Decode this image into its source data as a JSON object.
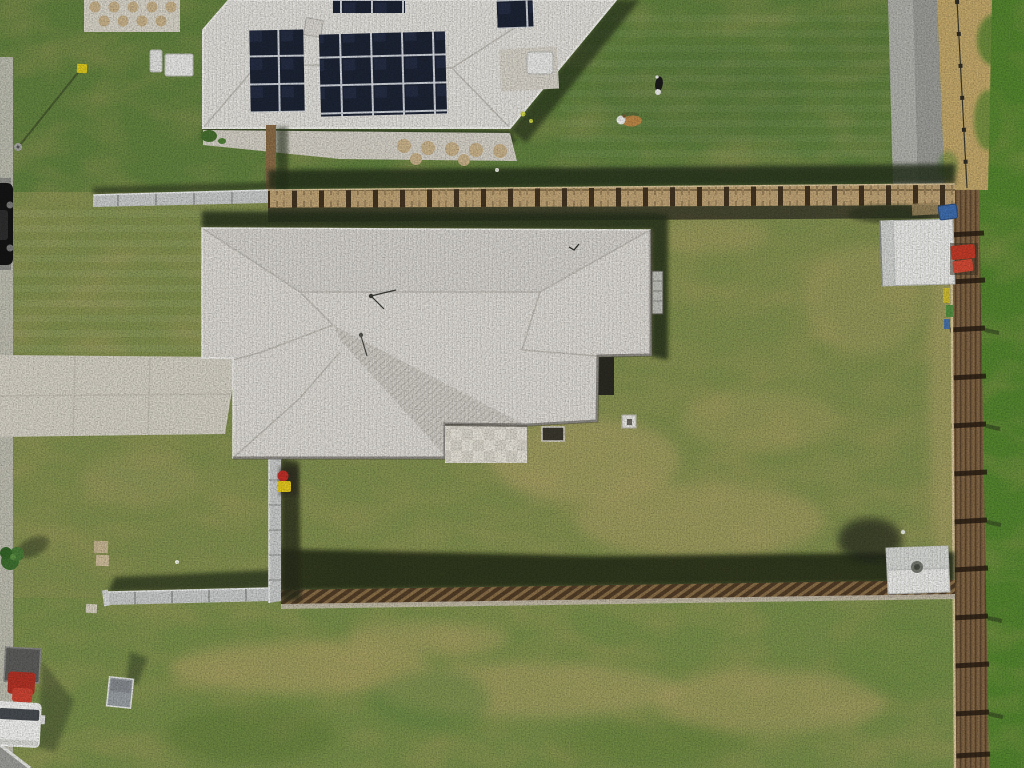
{
  "scene": {
    "type": "aerial-drone-photograph",
    "description": "Top-down drone photo of a suburban property: house with light grey hip roof, large olive-green yard, timber boundary fences, neighbouring house with rooftop solar panels, two dogs on neighbour lawn, white shed, driveway, street with parked vehicles",
    "objects": [
      {
        "name": "main-house-roof",
        "desc": "light grey corrugated hip roof",
        "box": [
          202,
          228,
          449,
          230
        ]
      },
      {
        "name": "neighbor-house-roof",
        "desc": "white corrugated roof with solar arrays",
        "box": [
          203,
          0,
          413,
          128
        ]
      },
      {
        "name": "solar-panels",
        "desc": "dark navy photovoltaic arrays",
        "box": [
          250,
          0,
          282,
          115
        ]
      },
      {
        "name": "dog-black-white",
        "box": [
          653,
          75,
          12,
          20
        ]
      },
      {
        "name": "dog-corgi",
        "box": [
          618,
          113,
          26,
          15
        ]
      },
      {
        "name": "garden-shed-large",
        "box": [
          880,
          219,
          75,
          67
        ]
      },
      {
        "name": "garden-shed-small",
        "box": [
          886,
          546,
          64,
          48
        ]
      },
      {
        "name": "wheelie-bins-red-yellow",
        "box": [
          276,
          470,
          16,
          22
        ]
      },
      {
        "name": "white-ute",
        "box": [
          0,
          648,
          44,
          98
        ]
      },
      {
        "name": "black-car",
        "box": [
          0,
          183,
          14,
          82
        ]
      },
      {
        "name": "driveway-concrete",
        "box": [
          0,
          354,
          233,
          84
        ]
      },
      {
        "name": "timber-boundary-fence-right",
        "box": [
          950,
          190,
          38,
          578
        ]
      },
      {
        "name": "timber-fence-top",
        "box": [
          268,
          184,
          687,
          24
        ]
      },
      {
        "name": "timber-fence-bottom",
        "box": [
          281,
          580,
          674,
          26
        ]
      },
      {
        "name": "colorbond-fence-grey",
        "box": [
          93,
          190,
          190,
          415
        ]
      }
    ]
  },
  "palette": {
    "lawn-main": "#82904f",
    "lawn-neighbor": "#63823f",
    "lawn-right": "#55852f",
    "lawn-paddock": "#7a8f4b",
    "dirt-tan": "#b5a56b",
    "dirt-strip": "#c3a86b",
    "roof-main": "#e0ddd8",
    "roof-face-north": "#d8d5d0",
    "roof-face-band": "#d0cdc7",
    "roof-gutter": "#f3f1ed",
    "roof-hip": "#bfbcb5",
    "roof-neighbor": "#e4e2dd",
    "eave-shadow": "#4d4a42",
    "shadow-dark": "#27301b",
    "shadow-soft": "#39422a",
    "solar-dark": "#1d2434",
    "solar-light": "#32405f",
    "driveway": "#d5d1c5",
    "concrete-path": "#d4d0c6",
    "footpath": "#c4c2ba",
    "asphalt": "#9c9c98",
    "asphalt-light": "#b6b6b2",
    "road-dark": "#8e8e8a",
    "fence-gray": "#c9cbca",
    "fence-gray-light": "#edeeee",
    "fence-wood-top": "#bfa375",
    "fence-wood-dark": "#433421",
    "fence-brown": "#7a5f3f",
    "fence-paling-light": "#d9c79c",
    "fence-rail-dark": "#241a10",
    "fence-slat-light": "#8a6f48",
    "fence-slat-dark": "#513d27",
    "fence-rail-pale": "#c6bfae",
    "shed-white": "#ececea",
    "shed-face": "#d2d4d1",
    "bin-red": "#c03028",
    "bin-yellow": "#e3c81f",
    "item-blue": "#3f6dad",
    "item-red": "#c23b28",
    "cargo-red": "#b23326",
    "vehicle-white": "#f1f1ef",
    "vehicle-glass": "#474c50",
    "car-black": "#141414",
    "tree-green": "#3f7030",
    "sign-gray": "#9aa0a4",
    "paver-tan": "#c8b28a",
    "paver-pale": "#d9d5cb",
    "dog-black": "#1a1a1a",
    "dog-white": "#ededeb",
    "dog-tan": "#bb8747",
    "ball-yellow": "#ccd24a",
    "marker-yellow": "#ddc91f"
  }
}
